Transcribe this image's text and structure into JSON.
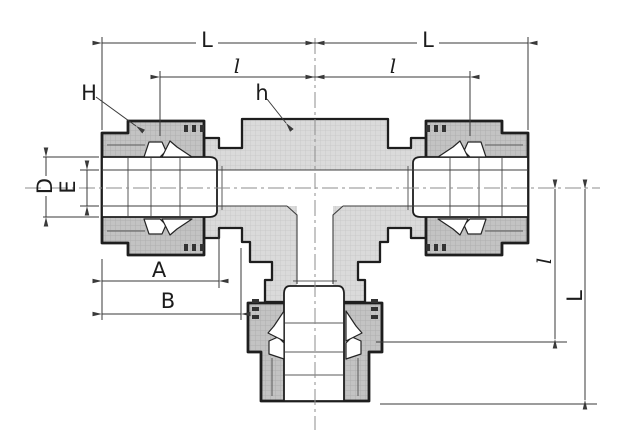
{
  "figure": {
    "kind": "engineering-cross-section-drawing",
    "subject": "union-tee-tube-fitting",
    "background": "#ffffff"
  },
  "colors": {
    "body-fill": "#dadada",
    "nut-fill": "#c3c3c3",
    "outline": "#1e1e1e",
    "inner-line": "#3d3d3d",
    "dim-line": "#3a3a3a",
    "centerline": "#8c8c8c",
    "label": "#1c1c1c",
    "bg": "#ffffff"
  },
  "labels": {
    "length_left": "L",
    "length_right": "L",
    "inner_left": "l",
    "inner_right": "l",
    "nut_wrench": "H",
    "body_wrench": "h",
    "outer_dia": "D",
    "bore_dia": "E",
    "dim_a": "A",
    "dim_b": "B",
    "branch_inner": "l",
    "branch_length": "L"
  }
}
